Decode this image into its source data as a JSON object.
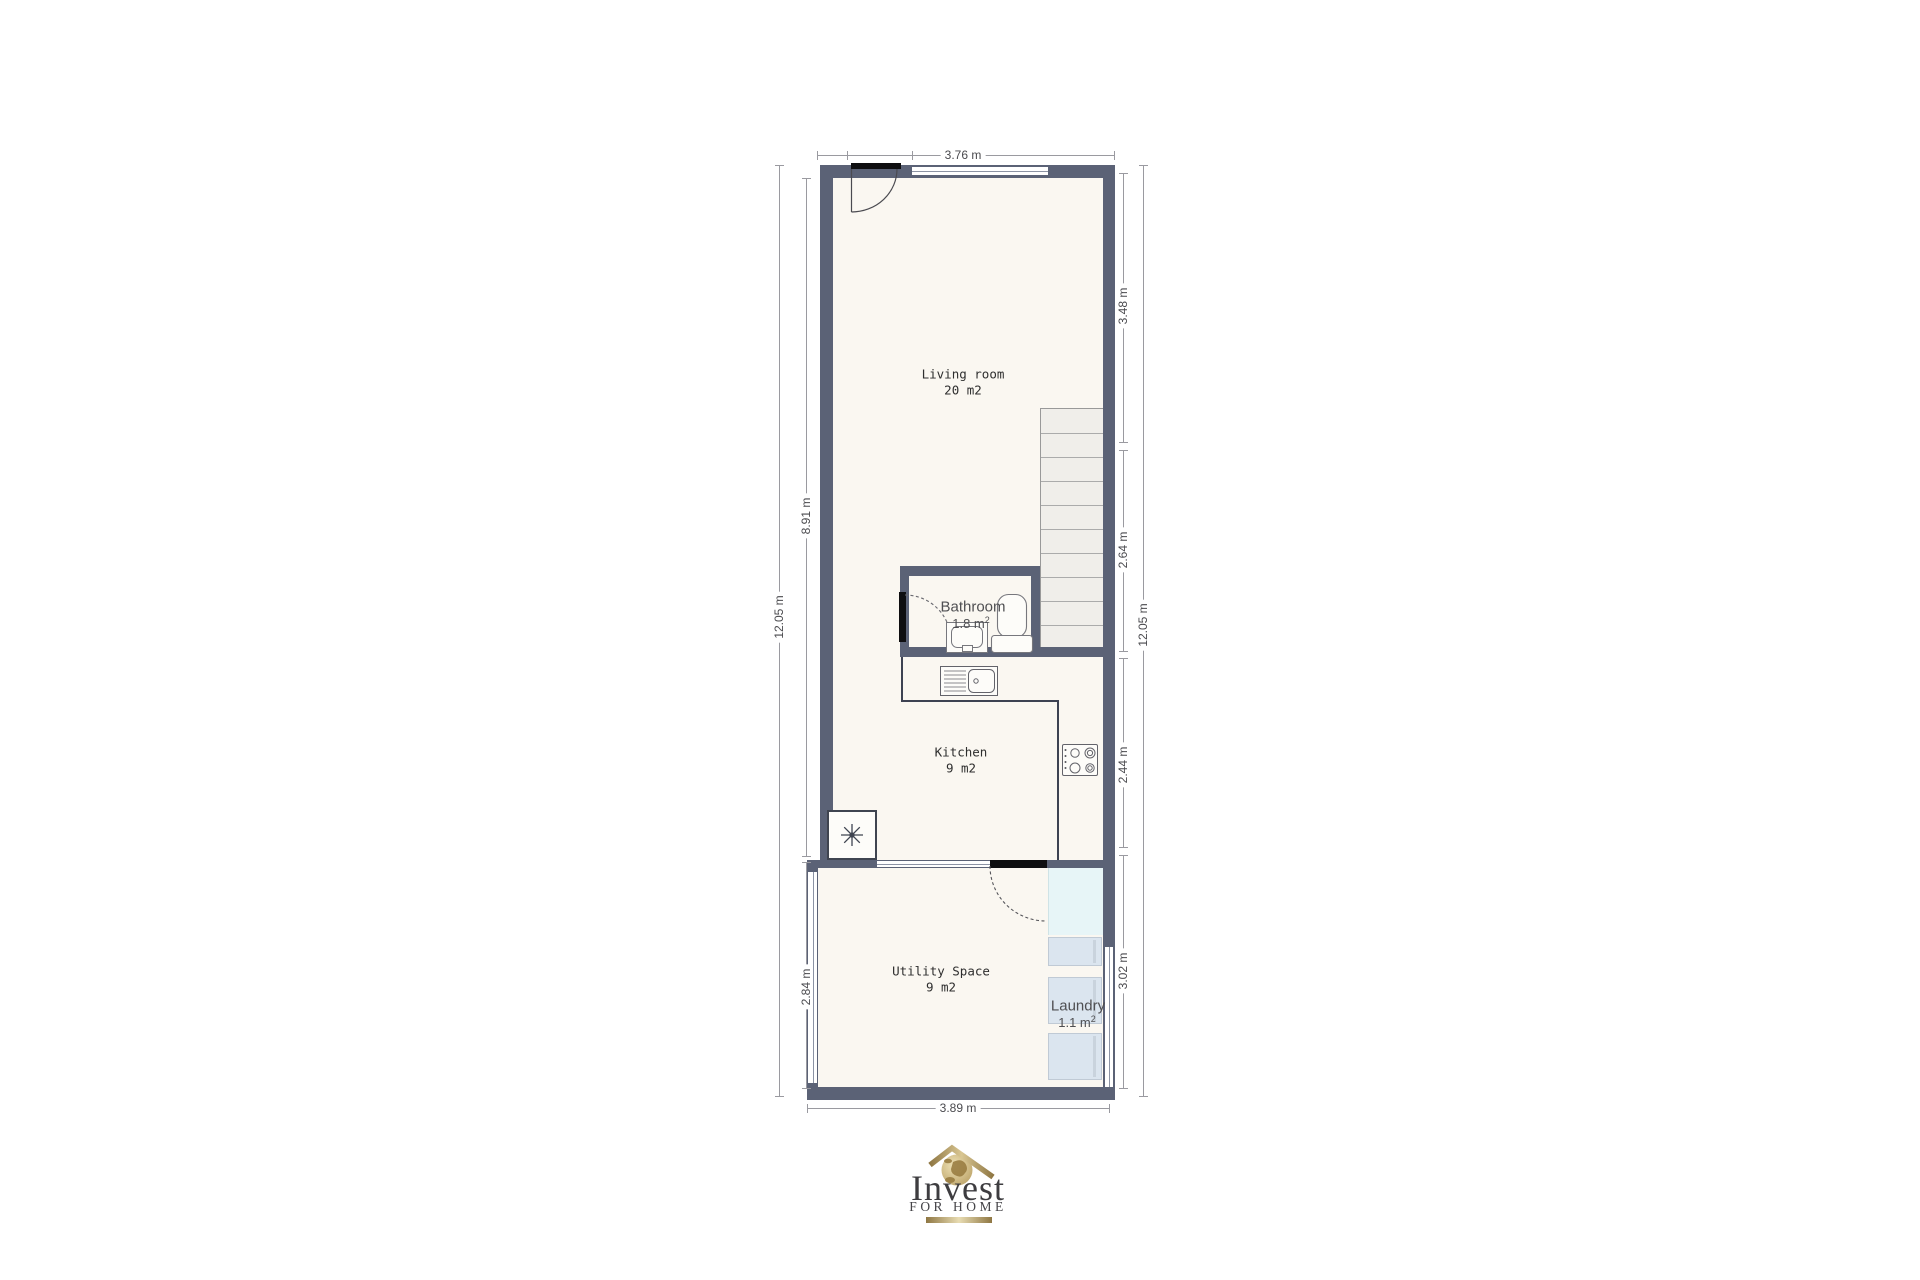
{
  "plan": {
    "rooms": {
      "living": {
        "label": "Living room",
        "area": "20 m2"
      },
      "bathroom": {
        "label": "Bathroom",
        "area": "1.8 m",
        "area_sup": "2"
      },
      "kitchen": {
        "label": "Kitchen",
        "area": "9 m2"
      },
      "utility": {
        "label": "Utility Space",
        "area": "9 m2"
      },
      "laundry": {
        "label": "Laundry",
        "area": "1.1 m",
        "area_sup": "2"
      }
    },
    "dimensions": {
      "top": "3.76 m",
      "bottom": "3.89 m",
      "left_outer": "12.05 m",
      "left_upper": "8.91 m",
      "left_lower": "2.84 m",
      "right_outer": "12.05 m",
      "right_living": "3.48 m",
      "right_stairs": "2.64 m",
      "right_kitchen": "2.44 m",
      "right_utility": "3.02 m"
    }
  },
  "logo": {
    "name": "Invest",
    "tagline": "FOR HOME"
  },
  "colors": {
    "wall": "#5b6276",
    "floor": "#faf7f1",
    "gold": "#a98e52",
    "laundry_zone": "#e7f5f7",
    "appliance": "#dbe5ef"
  }
}
